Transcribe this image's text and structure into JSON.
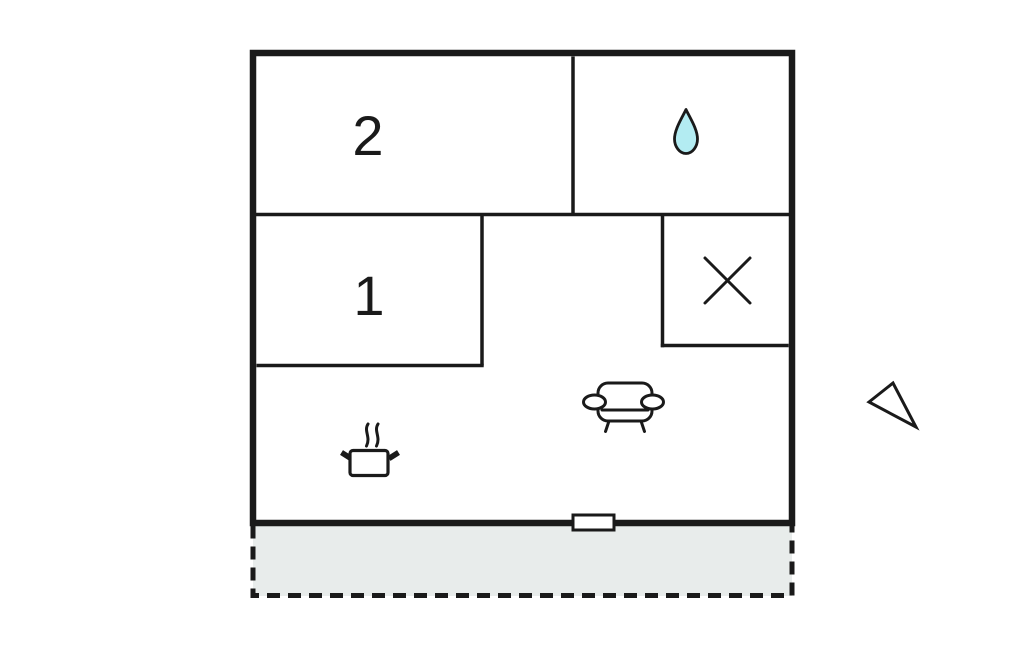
{
  "plan": {
    "room_labels": {
      "bedroom2": "2",
      "bedroom1": "1"
    }
  },
  "icons": {
    "bathroom": "water-drop-icon",
    "crossed_room": "x-mark-icon",
    "living_room": "sofa-icon",
    "kitchen": "cooking-pot-icon",
    "entrance": "door-marker",
    "orientation": "north-arrow-icon"
  },
  "colors": {
    "line": "#1a1a1a",
    "droplet-fill": "#b3ecf2",
    "terrace-fill": "#e8eceb",
    "background": "#ffffff"
  }
}
